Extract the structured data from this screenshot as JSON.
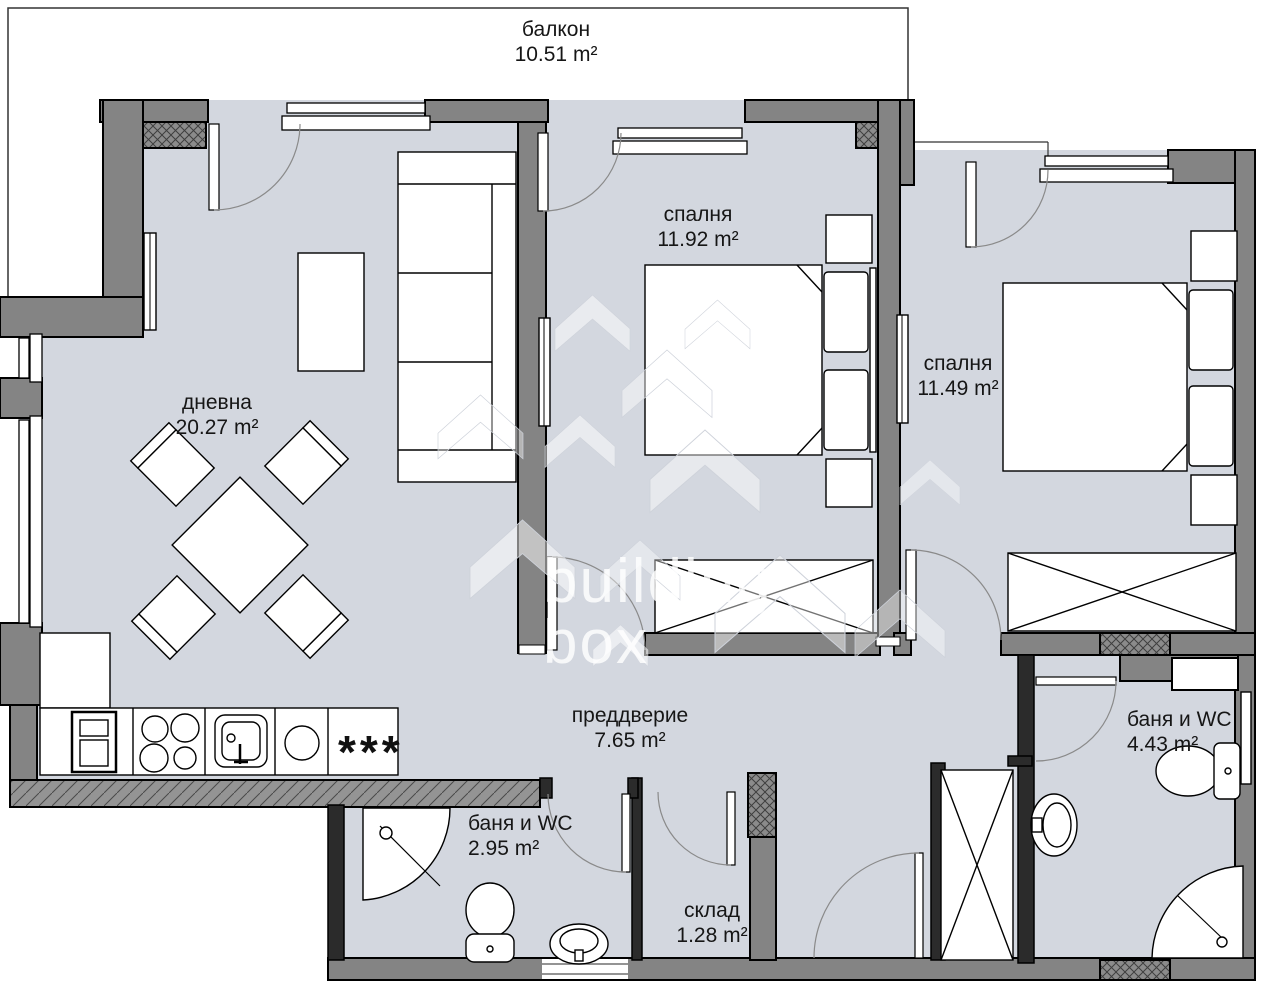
{
  "plan": {
    "floor_color": "#d3d7df",
    "wall_color": "#848484",
    "dark_wall_color": "#2b2b2b",
    "line_color": "#000000",
    "watermark_color": "rgba(255,255,255,0.8)"
  },
  "rooms": [
    {
      "id": "balcony",
      "name": "балкон",
      "area": "10.51 m²"
    },
    {
      "id": "bedroom-1",
      "name": "спалня",
      "area": "11.92 m²"
    },
    {
      "id": "bedroom-2",
      "name": "спалня",
      "area": "11.49 m²"
    },
    {
      "id": "living-room",
      "name": "дневна",
      "area": "20.27 m²"
    },
    {
      "id": "hallway",
      "name": "преддверие",
      "area": "7.65 m²"
    },
    {
      "id": "bathroom-2",
      "name": "баня и WC",
      "area": "4.43 m²"
    },
    {
      "id": "bathroom-1",
      "name": "баня и WC",
      "area": "2.95 m²"
    },
    {
      "id": "storage",
      "name": "склад",
      "area": "1.28 m²"
    }
  ],
  "watermark": {
    "line1": "building",
    "line2": "box"
  },
  "kitchen": {
    "hob_symbol": "***"
  }
}
